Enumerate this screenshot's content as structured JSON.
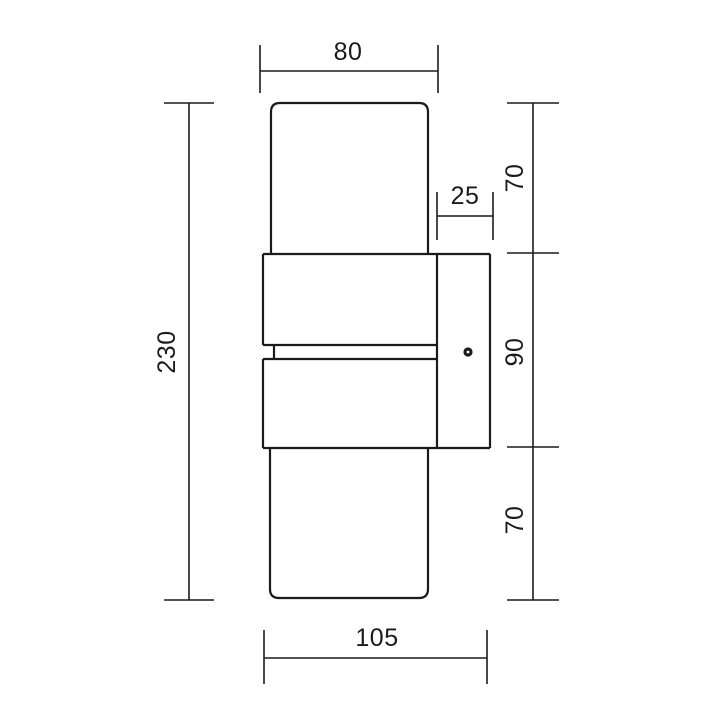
{
  "drawing": {
    "description": "Wall lamp technical dimension drawing, front-side view",
    "colors": {
      "background": "#ffffff",
      "line": "#1b1b1b"
    },
    "labels": {
      "width_top": "80",
      "height_top": "70",
      "plate_depth": "25",
      "height_middle": "90",
      "height_bottom": "70",
      "height_total": "230",
      "depth_total": "105"
    }
  }
}
